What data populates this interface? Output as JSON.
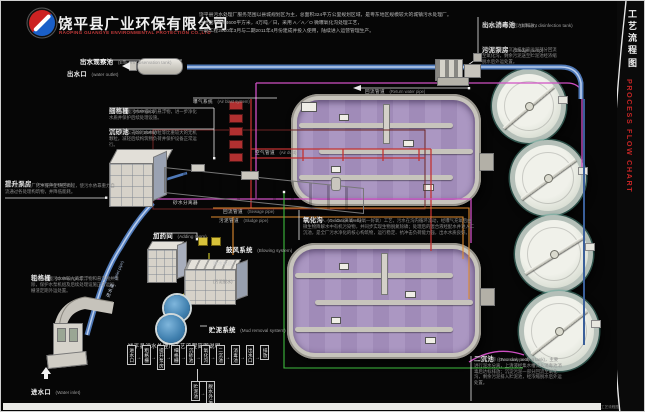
{
  "header": {
    "company_zh": "饶平县广业环保有限公司",
    "company_en": "RAOPING GUANGYE ENVIRONMENTAL PROTECTION CO.,LTD",
    "intro_line1": "饶平县污水处理厂服务范围以县城规划区为主，总面积324平方公里规划区域，是粤东地区规模较大的城镇污水处理厂。",
    "intro_line2": "占地面积约94600平方米，4万吨／日，采用 A／A／O 微曝氧化沟处理工艺，",
    "intro_line3": "一期工程2010年3月与二期2011年4月份建成并投入使用，陆续进入运营管理生产。"
  },
  "strip": {
    "title_zh": "工艺流程图",
    "title_en": "PROCESS FLOW CHART",
    "corner": "工艺流程图"
  },
  "labels": {
    "observation": {
      "zh": "出水观察池",
      "en": "(Effluent observation tank)"
    },
    "outlet": {
      "zh": "出水口",
      "en": "(water outlet)"
    },
    "fine_grid": {
      "zh": "细格栅",
      "en": "(Fine grid)",
      "desc": "细格栅拦截污水中细小的悬浮物，进一步净化水质并保护后续处理设施。"
    },
    "grit_basin": {
      "zh": "沉砂池",
      "en": "(Grit Basin)",
      "desc": "沉砂池用以去除污水中砂粒等比重较大的无机颗粒，减轻后续构筑物负荷并保护设备正常运行。"
    },
    "pumping": {
      "zh": "提升泵房",
      "en": "(Pumping station)",
      "desc": "提升泵房把进厂污水提升至场区高程，使污水依靠重力自流通过各处理构筑物，并降低能耗。"
    },
    "coarse_grid": {
      "zh": "粗格栅",
      "en": "(Coarse grid)",
      "desc": "粗格栅拦截污水中较大的漂浮物和悬浮物并清除，保护水泵机组及后续处理设施正常运行，栅渣定期外运处置。"
    },
    "inlet": {
      "zh": "进水口",
      "en": "(Water inlet)"
    },
    "disinfection": {
      "zh": "出水消毒池",
      "en": "(Effluent disinfection tank)",
      "desc": "出水经消毒处理后达标排放。"
    },
    "sludge_pump": {
      "zh": "污泥泵房",
      "en": "(Sludge pump)",
      "desc": "污泥泵房把二沉池排出的污泥部分回流至氧化沟，剩余污泥送至贮泥池经浓缩脱水后外运处置。"
    },
    "return_pipe": {
      "zh": "回流管道",
      "en": "(Return water pipe)"
    },
    "sewage_pipe": {
      "zh": "回流管道",
      "en": "(Sewage pipe)"
    },
    "sludge_pipe": {
      "zh": "污泥管道",
      "en": "(Sludge pipe)"
    },
    "dosing": {
      "zh": "加药间",
      "en": "(Adding room)"
    },
    "blower": {
      "zh": "鼓风系统",
      "en": "(Blowing system)"
    },
    "aeration": {
      "zh": "曝气系统",
      "en": "(Air blast system)"
    },
    "air_duct": {
      "zh": "空气管道",
      "en": "(Air duct)"
    },
    "oxidation": {
      "zh": "氧化沟",
      "en": "(Oxidation ditch)",
      "desc": "氧化沟为 A／A／O（厌氧—缺氧—好氧）工艺，污水在沟内循环流动，经曝气充氧后由微生物降解水中有机污染物，并同步实现生物脱氮除磷；处理后的混合液经配水井进入二沉池，是全厂污水净化的核心构筑物，运行稳定、抗冲击负荷能力强，出水水质良好。"
    },
    "mud_system": {
      "zh": "贮泥系统",
      "en": "(Mud removal system)"
    },
    "secondary": {
      "zh": "二沉池",
      "en": "(Two sink pool)",
      "desc": "二沉池又称 (secondary settling tank)，主要进行泥水分离，上清液经集水槽流入消毒池消毒后达标排放；沉淀污泥一部分回流至氧化沟，剩余污泥排入贮泥池，经浓缩脱水后外运处置。"
    },
    "sand_separator": {
      "zh": "砂水分离器"
    },
    "dewatering": {
      "zh": "脱水机房",
      "sub": "(污泥脱水)"
    },
    "inlet_channel": {
      "zh": "进水渠",
      "en": "(Inlet pipe)"
    }
  },
  "flow": {
    "title": "饶平县污水处理厂工艺流程简图说明。",
    "arrow": "→",
    "boxes": [
      "进水口",
      "粗格栅",
      "提升泵房",
      "细格栅",
      "沉砂池",
      "氧化沟",
      "二沉池",
      "消毒池",
      "出水口",
      "排放"
    ],
    "branch": [
      "贮泥池",
      "脱水外运"
    ]
  },
  "colors": {
    "pipe_blue": "#4f79b8",
    "pipe_magenta": "#cf4fc4",
    "pipe_red": "#c23232",
    "pipe_orange": "#df8a2e",
    "pipe_green": "#3dbb3d",
    "pipe_yellow": "#d6cf2a",
    "accent_red": "#c42525",
    "ditch_water": "#ab97c2"
  }
}
